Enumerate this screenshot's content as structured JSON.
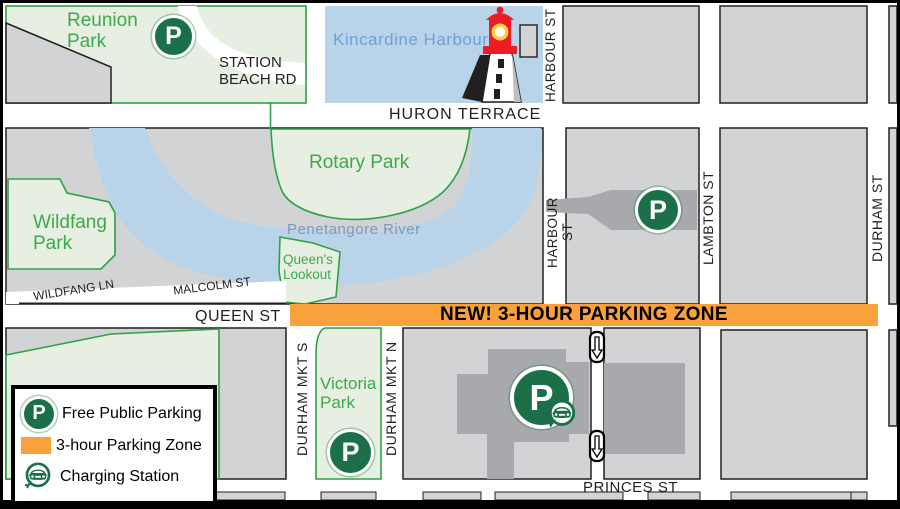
{
  "map": {
    "title": "Kincardine downtown parking map",
    "parks": {
      "reunion": "Reunion Park",
      "rotary": "Rotary Park",
      "wildfang": "Wildfang Park",
      "queens_lookout": "Queen's Lookout",
      "victoria": "Victoria Park"
    },
    "water": {
      "harbour": "Kincardine Harbour",
      "river": "Penetangore River"
    },
    "streets": {
      "station_beach": "STATION BEACH RD",
      "huron": "HURON TERRACE",
      "harbour_top": "HARBOUR ST",
      "harbour_mid": "HARBOUR ST",
      "lambton": "LAMBTON ST",
      "durham": "DURHAM ST",
      "wildfang_ln": "WILDFANG LN",
      "malcolm": "MALCOLM ST",
      "queen": "QUEEN ST",
      "durham_mkt_s": "DURHAM MKT S",
      "durham_mkt_n": "DURHAM MKT N",
      "princes": "PRINCES ST"
    },
    "banner": {
      "text": "NEW! 3-HOUR PARKING ZONE"
    },
    "icons": {
      "parking_letter": "P"
    },
    "colors": {
      "zone_orange": "#F9A13B",
      "parking_green": "#1B7049",
      "park_fill": "#E6EFE2",
      "park_border": "#2EA148",
      "park_text_green": "#3FA84C",
      "block_gray": "#D2D3D5",
      "parking_lot_gray": "#A7A9AC",
      "water_blue": "#B9D4E9",
      "harbour_text_blue": "#6FA0D4",
      "river_text_blue": "#7E97BA",
      "outline_black": "#231F20"
    }
  },
  "legend": {
    "items": [
      {
        "icon": "parking-icon",
        "label": "Free Public Parking"
      },
      {
        "icon": "zone-swatch",
        "label": "3-hour Parking Zone"
      },
      {
        "icon": "charging-icon",
        "label": "Charging Station"
      }
    ]
  }
}
